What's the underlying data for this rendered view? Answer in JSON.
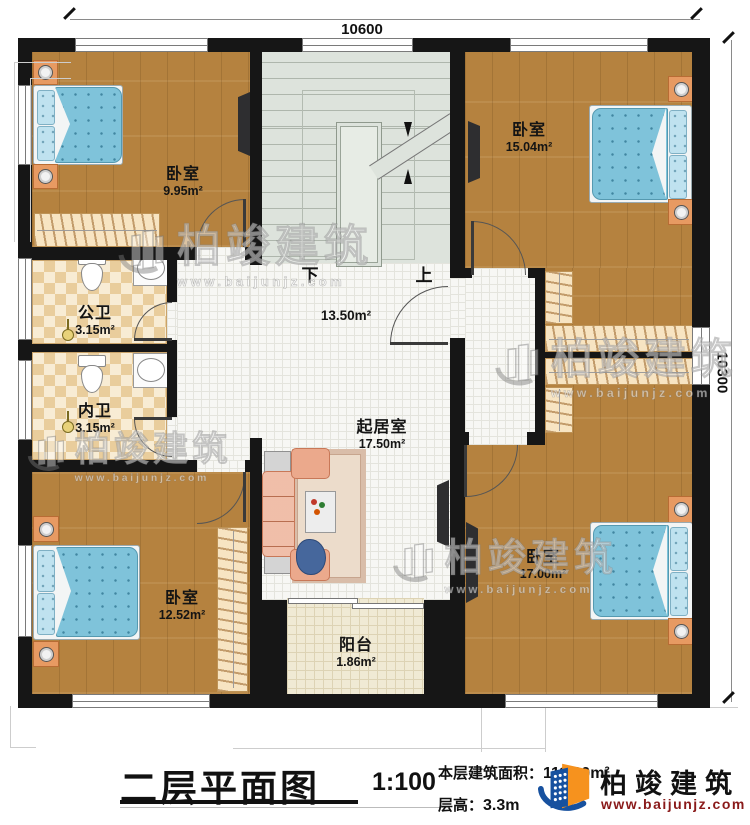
{
  "dimensions": {
    "top": "10600",
    "right": "10300"
  },
  "rooms": {
    "bedroom_tl": {
      "name": "卧室",
      "area": "9.95m²"
    },
    "bedroom_tr": {
      "name": "卧室",
      "area": "15.04m²"
    },
    "bedroom_bl": {
      "name": "卧室",
      "area": "12.52m²"
    },
    "bedroom_br": {
      "name": "卧室",
      "area": "17.00m²"
    },
    "bath_public": {
      "name": "公卫",
      "area": "3.15m²"
    },
    "bath_private": {
      "name": "内卫",
      "area": "3.15m²"
    },
    "living": {
      "name": "起居室",
      "area": "17.50m²"
    },
    "balcony": {
      "name": "阳台",
      "area": "1.86m²"
    },
    "hall": {
      "area": "13.50m²"
    }
  },
  "stairs": {
    "down_label": "下",
    "up_label": "上"
  },
  "title_block": {
    "title": "二层平面图",
    "scale": "1:100",
    "floor_area_label": "本层建筑面积：",
    "floor_area_value": "111.00m²",
    "floor_height_label": "层高：",
    "floor_height_value": "3.3m"
  },
  "brand": {
    "name": "柏竣建筑",
    "url": "www.baijunjz.com"
  },
  "watermark": {
    "name": "柏竣建筑",
    "url": "www.baijunjz.com"
  },
  "colors": {
    "wall": "#161616",
    "wood_floor": "#b5823f",
    "tile_floor": "#f7f7f4",
    "stair_floor": "#dde3dc",
    "balcony_floor": "#f0ead4",
    "bath_tile": "#e9cd9c",
    "closet": "#f7e4c2",
    "bed_blanket": "#7fc3da",
    "nightstand": "#e79a62",
    "sofa": "#eba98c",
    "brand_blue": "#17519f",
    "brand_orange": "#f6921e",
    "url_red": "#8a1a1a"
  }
}
